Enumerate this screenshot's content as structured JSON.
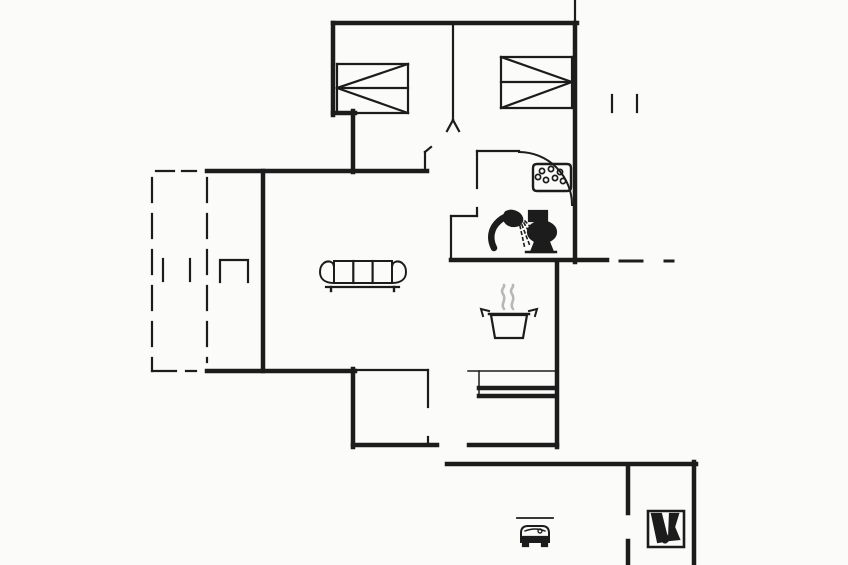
{
  "canvas": {
    "width": 848,
    "height": 565,
    "background": "#fbfbf9",
    "line_color": "#1c1c1c",
    "steam_color": "#b7b7b7"
  },
  "floorplan": {
    "thick_walls": [
      [
        333,
        23,
        577,
        23
      ],
      [
        575,
        23,
        575,
        262
      ],
      [
        333,
        23,
        333,
        115
      ],
      [
        333,
        113,
        355,
        113
      ],
      [
        353,
        111,
        353,
        172
      ],
      [
        207,
        171,
        427,
        171
      ],
      [
        263,
        171,
        263,
        371
      ],
      [
        207,
        371,
        355,
        371
      ],
      [
        353,
        369,
        353,
        447
      ],
      [
        353,
        445,
        437,
        445
      ],
      [
        469,
        445,
        557,
        445
      ],
      [
        557,
        262,
        557,
        447
      ],
      [
        451,
        260,
        607,
        260
      ],
      [
        447,
        464,
        696,
        464
      ],
      [
        694,
        462,
        694,
        565
      ],
      [
        628,
        466,
        628,
        513
      ],
      [
        628,
        541,
        628,
        565
      ],
      [
        479,
        388,
        556,
        388
      ],
      [
        479,
        396,
        556,
        396
      ]
    ],
    "medium_lines": [
      [
        575,
        0,
        575,
        23
      ],
      [
        453,
        23,
        453,
        120
      ],
      [
        453,
        120,
        447,
        131
      ],
      [
        453,
        120,
        459,
        131
      ],
      [
        425,
        152,
        425,
        171
      ],
      [
        425,
        152,
        431,
        147
      ],
      [
        477,
        151,
        519,
        151
      ],
      [
        477,
        151,
        477,
        188
      ],
      [
        477,
        208,
        477,
        216
      ],
      [
        451,
        216,
        477,
        216
      ],
      [
        451,
        216,
        451,
        260
      ],
      [
        612,
        95,
        612,
        112
      ],
      [
        637,
        95,
        637,
        112
      ],
      [
        163,
        259,
        163,
        281
      ],
      [
        190,
        259,
        190,
        281
      ],
      [
        355,
        370,
        428,
        370
      ],
      [
        428,
        370,
        428,
        407
      ],
      [
        428,
        437,
        428,
        445
      ]
    ],
    "hair_lines": [
      [
        468,
        371,
        556,
        371
      ],
      [
        479,
        371,
        479,
        397
      ]
    ],
    "dashed_lines": [
      {
        "l": [
          152,
          178,
          152,
          371
        ],
        "dash": "24 12"
      },
      {
        "l": [
          207,
          178,
          207,
          362
        ],
        "dash": "24 12"
      },
      {
        "l": [
          156,
          171,
          196,
          171
        ],
        "dash": "18 8"
      },
      {
        "l": [
          152,
          371,
          196,
          371
        ],
        "dash": "24 10"
      }
    ],
    "paths": [
      {
        "name": "terrace-door-jamb",
        "d": "M220,282 L220,260 L248,260 L248,282",
        "w": 2.2
      },
      {
        "name": "door-swing-arc",
        "d": "M519,152 A53,53 0 0 1 572,205",
        "w": 2
      },
      {
        "name": "wall-extension-dashes",
        "d": "M620,261 H642 M665,261 H673",
        "w": 3
      }
    ],
    "icons": [
      {
        "name": "double-bed-icon-bedroom-1",
        "elements": [
          {
            "l": [
              337,
              64,
              408,
              64
            ]
          },
          {
            "l": [
              408,
              64,
              408,
              113
            ]
          },
          {
            "l": [
              337,
              113,
              408,
              113
            ]
          },
          {
            "l": [
              337,
              64,
              337,
              113
            ]
          },
          {
            "l": [
              337,
              88,
              408,
              88
            ]
          },
          {
            "l": [
              408,
              64,
              337,
              88
            ]
          },
          {
            "l": [
              337,
              88,
              408,
              113
            ]
          }
        ]
      },
      {
        "name": "double-bed-icon-bedroom-2",
        "elements": [
          {
            "l": [
              501,
              57,
              572,
              57
            ]
          },
          {
            "l": [
              572,
              57,
              572,
              108
            ]
          },
          {
            "l": [
              501,
              108,
              572,
              108
            ]
          },
          {
            "l": [
              501,
              57,
              501,
              108
            ]
          },
          {
            "l": [
              501,
              82,
              572,
              82
            ]
          },
          {
            "l": [
              501,
              57,
              572,
              82
            ]
          },
          {
            "l": [
              572,
              82,
              501,
              108
            ]
          }
        ]
      },
      {
        "name": "sofa-icon",
        "elements": [
          {
            "d": "M334,261 H392 V283 H334 Z",
            "w": 2
          },
          {
            "l": [
              353.3,
              261,
              353.3,
              283
            ]
          },
          {
            "l": [
              372.6,
              261,
              372.6,
              283
            ]
          },
          {
            "d": "M334,283 C325,283 320,279 320,272 C320,264 326,260 331,262 C333.5,263 334,265 334,268",
            "w": 2
          },
          {
            "d": "M392,283 C401,283 406,279 406,272 C406,264 400,260 395,262 C392.5,263 392,265 392,268",
            "w": 2
          },
          {
            "l": [
              326,
              287,
              399,
              287
            ]
          },
          {
            "l": [
              331,
              287,
              331,
              291
            ],
            "w": 2.4
          },
          {
            "l": [
              394,
              287,
              394,
              291
            ],
            "w": 2.4
          }
        ]
      },
      {
        "name": "cooking-pot-icon",
        "elements": [
          {
            "d": "M504,309 C500,304 507,300 503,294 C500,289 505,288 504,285",
            "w": 2.6,
            "c": "#b7b7b7",
            "cap": "round"
          },
          {
            "d": "M513,309 C509,304 516,300 512,294 C509,289 514,288 513,285",
            "w": 2.6,
            "c": "#b7b7b7",
            "cap": "round"
          },
          {
            "d": "M491,315 L495,338 L523,338 L527,315 Z",
            "w": 2.2
          },
          {
            "l": [
              489,
              314,
              529,
              314
            ],
            "w": 2.5
          },
          {
            "d": "M489,311 L481,309 L483,316",
            "w": 2
          },
          {
            "d": "M529,311 L537,309 L535,316",
            "w": 2
          }
        ]
      },
      {
        "name": "shower-icon",
        "elements": [
          {
            "d": "M494,248 C489,238 491,228 499,221 C504,216.5 509,215 513,217",
            "w": 6.5,
            "cap": "round"
          },
          {
            "d": "M506,212 C512,209 520,212 522,218 C523,222 520,226 514,226 C508,226 504,222 504,218 C504,215 505,213 506,212 Z",
            "f": "fill"
          },
          {
            "d": "M520,226 L525,249",
            "w": 1.6,
            "dash": "2.5 3.5"
          },
          {
            "d": "M522,225 L530,246",
            "w": 1.6,
            "dash": "2.5 3.5"
          },
          {
            "d": "M524,223 L534,241",
            "w": 1.6,
            "dash": "2.5 3.5"
          },
          {
            "d": "M525,221 L537,234",
            "w": 1.6,
            "dash": "2.5 3.5"
          }
        ]
      },
      {
        "name": "toilet-icon",
        "elements": [
          {
            "d": "M529,211 H547 V221 H529 Z",
            "f": "fill"
          },
          {
            "d": "M528,232 a14,10.5 0 1 0 28,0 a14,10.5 0 1 0 -28,0",
            "f": "fill"
          },
          {
            "d": "M531,252 L553,252 L549,242 L535,242 Z",
            "f": "fill"
          },
          {
            "l": [
              526,
              252,
              556,
              252
            ],
            "w": 2.4
          }
        ]
      },
      {
        "name": "hob-dots-icon",
        "elements": [
          {
            "d": "M537,164 H567 Q571,164 571,168 V187 Q571,191 567,191 H537 Q533,191 533,187 V168 Q533,164 537,164 Z",
            "w": 2.4
          },
          {
            "cx": 542,
            "cy": 171,
            "r": 2.6,
            "w": 1.7
          },
          {
            "cx": 551,
            "cy": 169,
            "r": 2.6,
            "w": 1.7
          },
          {
            "cx": 560,
            "cy": 172,
            "r": 2.6,
            "w": 1.7
          },
          {
            "cx": 538,
            "cy": 177,
            "r": 2.6,
            "w": 1.7
          },
          {
            "cx": 546,
            "cy": 180,
            "r": 2.6,
            "w": 1.7
          },
          {
            "cx": 555,
            "cy": 178,
            "r": 2.6,
            "w": 1.7
          },
          {
            "cx": 563,
            "cy": 181,
            "r": 2.6,
            "w": 1.7
          }
        ]
      },
      {
        "name": "car-icon",
        "elements": [
          {
            "l": [
              517,
              518,
              553,
              518
            ],
            "w": 1.8
          },
          {
            "d": "M521,542 V533 Q521,526 528,526 H542 Q549,526 549,533 V542 Z",
            "w": 2
          },
          {
            "d": "M525,531 Q535,527 545,531",
            "w": 1.4
          },
          {
            "d": "M522,537 H548 V541 H522 Z",
            "f": "fill"
          },
          {
            "d": "M523,542 h5 v4 h-5 Z",
            "f": "fill"
          },
          {
            "d": "M542,542 h5 v4 h-5 Z",
            "f": "fill"
          },
          {
            "cx": 540,
            "cy": 531,
            "r": 2,
            "w": 1.4
          }
        ]
      },
      {
        "name": "tools-shed-icon",
        "elements": [
          {
            "d": "M648,511 H684 V547 H648 Z",
            "w": 2.6
          },
          {
            "d": "M652,514 L661,514 L666,534 L669,540 L658,542 Z",
            "f": "fill"
          },
          {
            "d": "M670,514 L678,514 L674,527 L679,539 L669,540 Z",
            "f": "fill"
          },
          {
            "cx": 665,
            "cy": 540,
            "r": 2.8,
            "w": 1.6,
            "f": "fill"
          }
        ]
      }
    ]
  }
}
